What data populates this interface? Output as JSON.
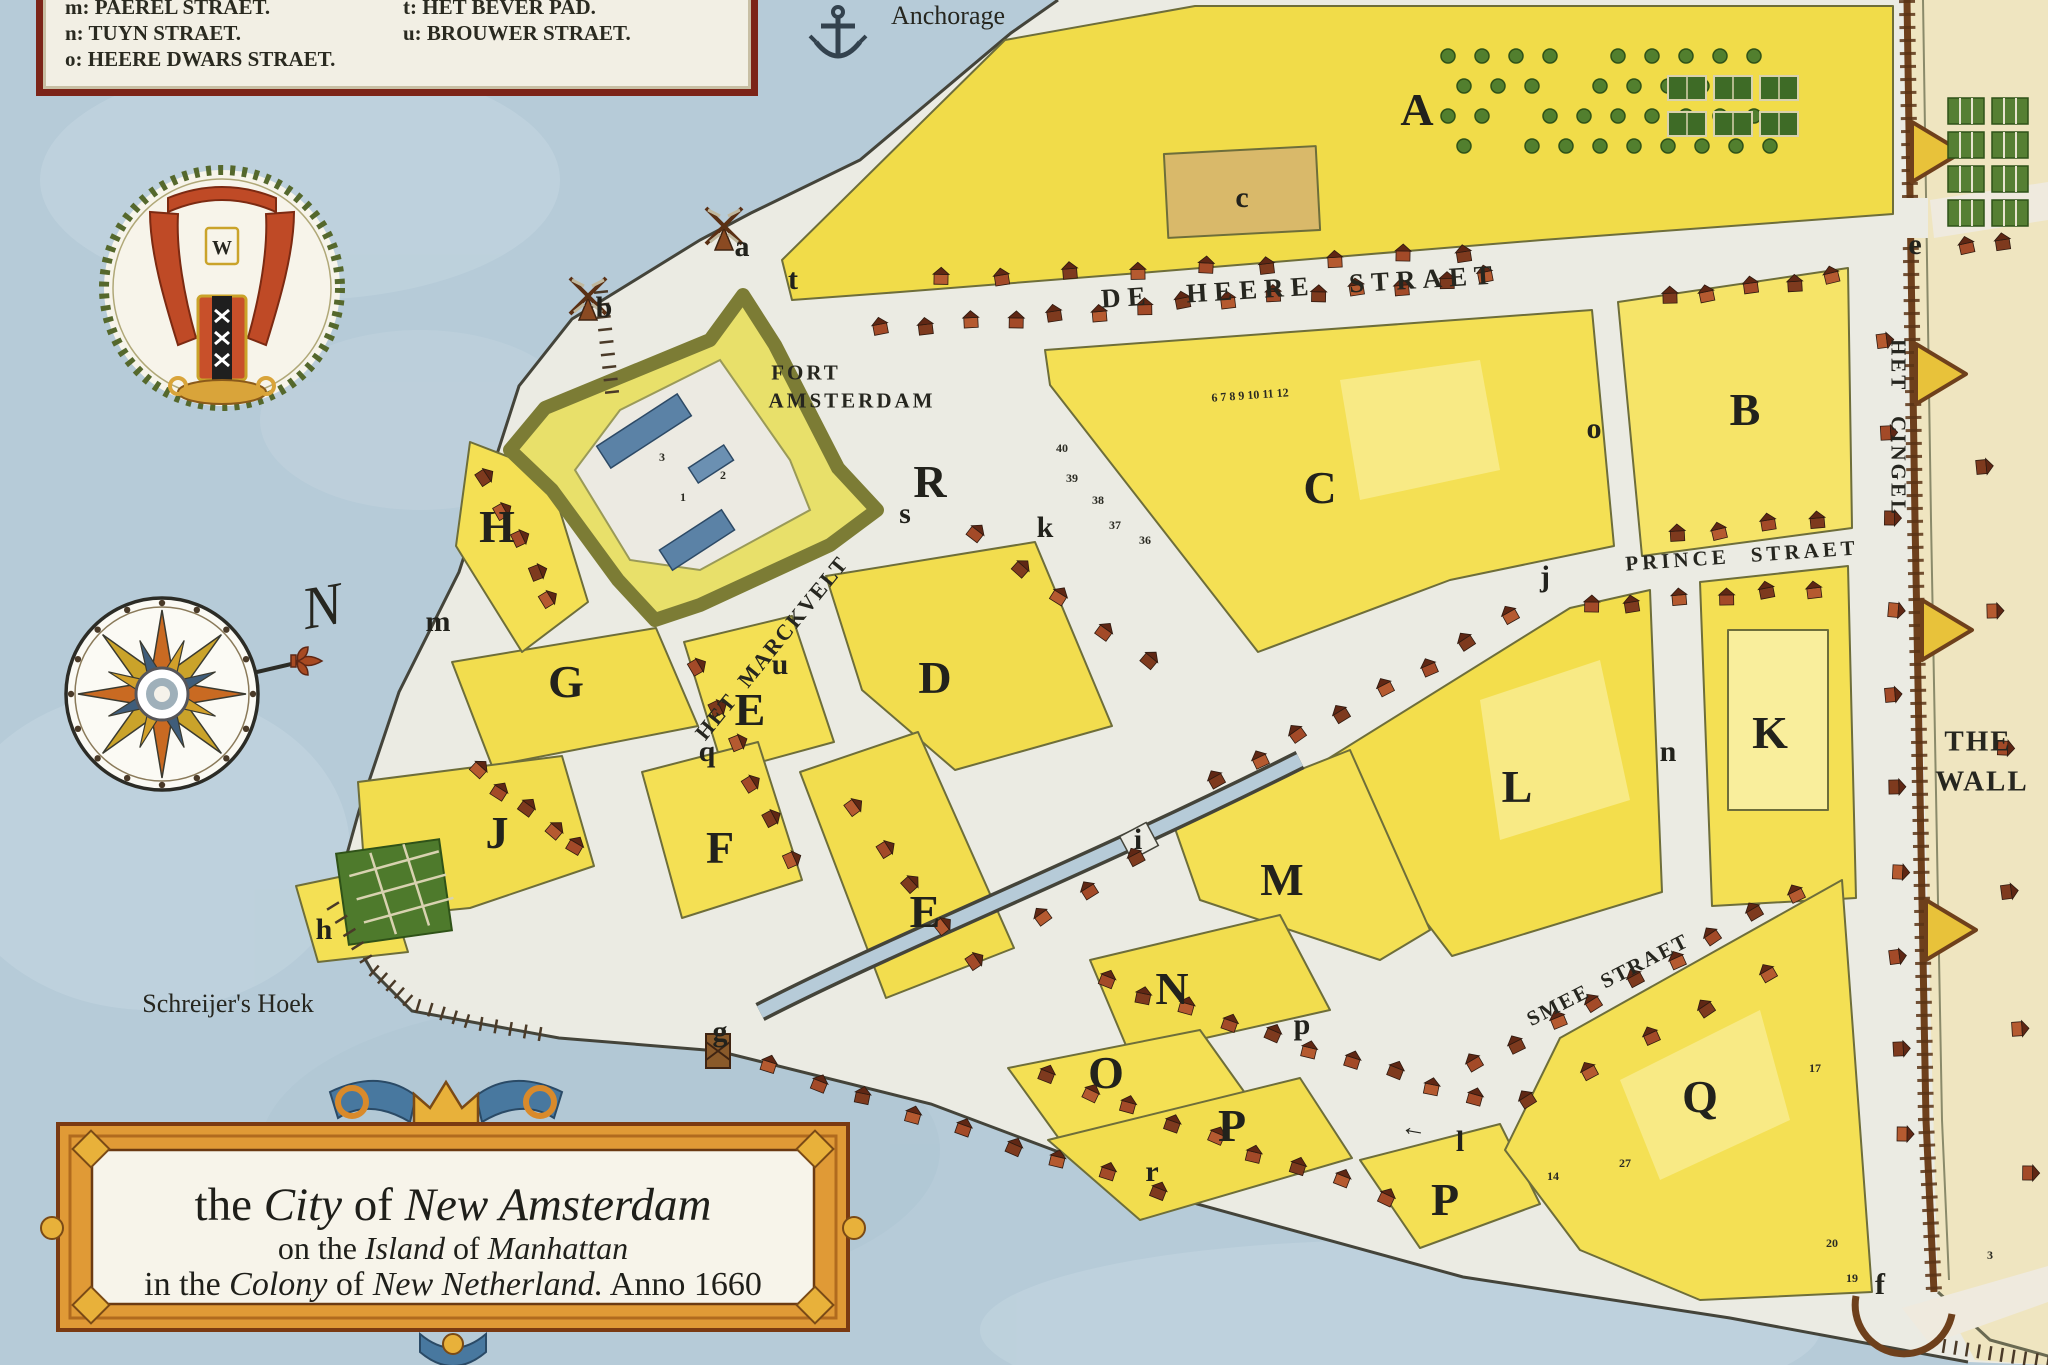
{
  "map_title_plate": {
    "line1": [
      {
        "t": "the ",
        "i": false
      },
      {
        "t": "City",
        "i": true
      },
      {
        "t": " of ",
        "i": false
      },
      {
        "t": "New Amsterdam",
        "i": true
      }
    ],
    "line2": [
      {
        "t": "on the ",
        "i": false
      },
      {
        "t": "Island",
        "i": true
      },
      {
        "t": " of ",
        "i": false
      },
      {
        "t": "Manhattan",
        "i": true
      }
    ],
    "line3": [
      {
        "t": "in the ",
        "i": false
      },
      {
        "t": "Colony",
        "i": true
      },
      {
        "t": " of ",
        "i": false
      },
      {
        "t": "New Netherland.",
        "i": true
      },
      {
        "t": " Anno 1660",
        "i": false
      }
    ]
  },
  "legend": {
    "left": [
      "m: PAEREL STRAET.",
      "n: TUYN STRAET.",
      "o: HEERE DWARS STRAET."
    ],
    "right": [
      "t: HET  BEVER PAD.",
      "u: BROUWER STRAET."
    ]
  },
  "labels": {
    "items": [
      {
        "id": "de-heere-straet",
        "t": "DE HEERE STRAET",
        "x": 1300,
        "y": 287,
        "r": -3.5,
        "s": 27,
        "ls": 7,
        "ws": 20,
        "w": 700
      },
      {
        "id": "prince-straet",
        "t": "PRINCE STRAET",
        "x": 1742,
        "y": 556,
        "r": -4,
        "s": 21,
        "ls": 4,
        "ws": 12,
        "w": 700
      },
      {
        "id": "het-marckvelt",
        "t": "HET MARCKVELT",
        "x": 772,
        "y": 648,
        "r": -51,
        "s": 22,
        "ls": 2,
        "ws": 8,
        "w": 700
      },
      {
        "id": "smee-straet",
        "t": "SMEE STRAET",
        "x": 1608,
        "y": 980,
        "r": -27,
        "s": 21,
        "ls": 2,
        "ws": 8,
        "w": 700
      },
      {
        "id": "het-cingel",
        "t": "HET CINGEL",
        "x": 1898,
        "y": 428,
        "r": 90,
        "s": 21,
        "ls": 3,
        "ws": 16,
        "w": 700
      },
      {
        "id": "the-wall-line1",
        "t": "THE",
        "x": 1978,
        "y": 742,
        "r": 0,
        "s": 29,
        "ls": 2,
        "w": 700
      },
      {
        "id": "the-wall-line2",
        "t": "WALL",
        "x": 1982,
        "y": 782,
        "r": 0,
        "s": 29,
        "ls": 2,
        "w": 700
      },
      {
        "id": "fort-amsterdam-line1",
        "t": "FORT",
        "x": 806,
        "y": 373,
        "r": 0,
        "s": 21,
        "ls": 3,
        "w": 700
      },
      {
        "id": "fort-amsterdam-line2",
        "t": "AMSTERDAM",
        "x": 852,
        "y": 401,
        "r": 0,
        "s": 21,
        "ls": 3,
        "w": 700
      },
      {
        "id": "anchorage",
        "t": "Anchorage",
        "x": 948,
        "y": 16,
        "r": 0,
        "s": 26,
        "ls": 0,
        "w": 400
      },
      {
        "id": "schreijers-hoek",
        "t": "Schreijer's Hoek",
        "x": 228,
        "y": 1004,
        "r": 0,
        "s": 26,
        "ls": 0,
        "w": 400
      },
      {
        "id": "north-n",
        "t": "N",
        "x": 322,
        "y": 606,
        "r": -10,
        "s": 60,
        "ls": 0,
        "w": 400,
        "st": "italic"
      },
      {
        "id": "crest-w",
        "t": "W",
        "x": 222,
        "y": 248,
        "r": 0,
        "s": 20,
        "ls": 0,
        "w": 700
      },
      {
        "id": "arrow-near-l",
        "t": "←",
        "x": 1414,
        "y": 1128,
        "r": 10,
        "s": 26,
        "ls": 0,
        "w": 700
      }
    ]
  },
  "blocks": [
    {
      "label": "A",
      "x": 1417,
      "y": 110
    },
    {
      "label": "B",
      "x": 1745,
      "y": 410
    },
    {
      "label": "C",
      "x": 1320,
      "y": 488
    },
    {
      "label": "D",
      "x": 935,
      "y": 678
    },
    {
      "label": "E",
      "x": 750,
      "y": 710
    },
    {
      "label": "E",
      "x": 925,
      "y": 912
    },
    {
      "label": "F",
      "x": 720,
      "y": 848
    },
    {
      "label": "G",
      "x": 566,
      "y": 682
    },
    {
      "label": "H",
      "x": 497,
      "y": 527
    },
    {
      "label": "J",
      "x": 497,
      "y": 833
    },
    {
      "label": "K",
      "x": 1770,
      "y": 733
    },
    {
      "label": "L",
      "x": 1517,
      "y": 787
    },
    {
      "label": "M",
      "x": 1282,
      "y": 880
    },
    {
      "label": "N",
      "x": 1172,
      "y": 989
    },
    {
      "label": "O",
      "x": 1106,
      "y": 1073
    },
    {
      "label": "P",
      "x": 1232,
      "y": 1126
    },
    {
      "label": "P",
      "x": 1445,
      "y": 1200
    },
    {
      "label": "Q",
      "x": 1700,
      "y": 1097
    },
    {
      "label": "R",
      "x": 930,
      "y": 482
    }
  ],
  "sites": [
    {
      "label": "a",
      "x": 742,
      "y": 247
    },
    {
      "label": "b",
      "x": 604,
      "y": 308
    },
    {
      "label": "c",
      "x": 1242,
      "y": 198
    },
    {
      "label": "e",
      "x": 1915,
      "y": 245
    },
    {
      "label": "f",
      "x": 1880,
      "y": 1285
    },
    {
      "label": "g",
      "x": 720,
      "y": 1032
    },
    {
      "label": "h",
      "x": 324,
      "y": 930
    },
    {
      "label": "i",
      "x": 1138,
      "y": 840
    },
    {
      "label": "j",
      "x": 1545,
      "y": 577
    },
    {
      "label": "k",
      "x": 1045,
      "y": 528
    },
    {
      "label": "l",
      "x": 1460,
      "y": 1142
    },
    {
      "label": "m",
      "x": 438,
      "y": 622
    },
    {
      "label": "n",
      "x": 1668,
      "y": 752
    },
    {
      "label": "o",
      "x": 1594,
      "y": 429
    },
    {
      "label": "p",
      "x": 1302,
      "y": 1025
    },
    {
      "label": "q",
      "x": 707,
      "y": 752
    },
    {
      "label": "r",
      "x": 1152,
      "y": 1172
    },
    {
      "label": "s",
      "x": 905,
      "y": 514
    },
    {
      "label": "t",
      "x": 793,
      "y": 280
    },
    {
      "label": "u",
      "x": 780,
      "y": 665
    }
  ],
  "lot_numbers": [
    {
      "t": "6 7 8 9 10 11 12",
      "x": 1250,
      "y": 395,
      "r": -4
    },
    {
      "t": "40",
      "x": 1062,
      "y": 448,
      "r": 0
    },
    {
      "t": "39",
      "x": 1072,
      "y": 478,
      "r": 0
    },
    {
      "t": "38",
      "x": 1098,
      "y": 500,
      "r": 0
    },
    {
      "t": "37",
      "x": 1115,
      "y": 525,
      "r": 0
    },
    {
      "t": "36",
      "x": 1145,
      "y": 540,
      "r": 0
    },
    {
      "t": "27",
      "x": 1625,
      "y": 1163,
      "r": 0
    },
    {
      "t": "14",
      "x": 1553,
      "y": 1176,
      "r": 0
    },
    {
      "t": "17",
      "x": 1815,
      "y": 1068,
      "r": 0
    },
    {
      "t": "20",
      "x": 1832,
      "y": 1243,
      "r": 0
    },
    {
      "t": "19",
      "x": 1852,
      "y": 1278,
      "r": 0
    },
    {
      "t": "3",
      "x": 1990,
      "y": 1255,
      "r": 0
    },
    {
      "t": "3",
      "x": 662,
      "y": 457,
      "r": 0
    },
    {
      "t": "1",
      "x": 683,
      "y": 497,
      "r": 0
    },
    {
      "t": "2",
      "x": 723,
      "y": 475,
      "r": 0
    }
  ],
  "colors": {
    "water": "#b6cbd8",
    "street_white": "#ebebe3",
    "block_yellow": "#f2dd4e",
    "block_yellow_light": "#f6e87e",
    "beyond_wall_cream": "#efe5c0",
    "wall_brown": "#6e401c",
    "fort_rampart": "#85853c",
    "roof_red": "#a34a28",
    "cartouche_gold": "#e09a36",
    "ribbon_blue": "#48789f",
    "ink": "#26261f",
    "garden_green": "#4e7a2c"
  }
}
